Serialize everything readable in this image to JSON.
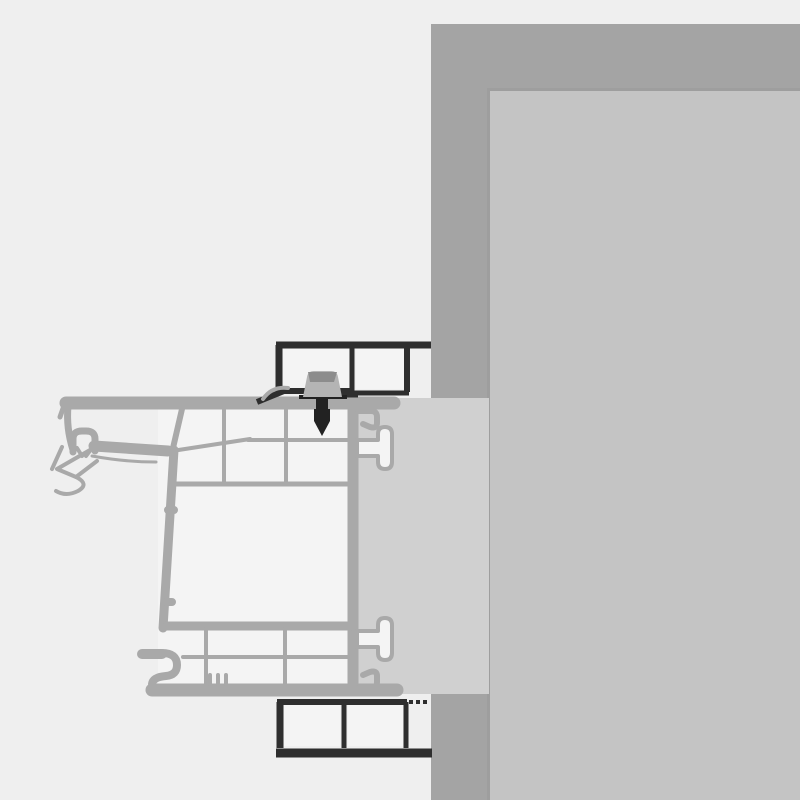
{
  "diagram": {
    "kind": "technical-cross-section",
    "parts": {
      "background": "canvas-background",
      "wall": "masonry-wall",
      "reveal": "wall-reveal-surface",
      "block": "frame-extension-block",
      "frame": "window-frame-profile",
      "gasket": "outer-gasket",
      "addon_top": "exterior-addon-profile-top",
      "addon_bottom": "exterior-addon-profile-bottom",
      "screw": "fixing-screw",
      "anchor_top": "t-anchor-top",
      "anchor_bottom": "t-anchor-bottom"
    }
  },
  "colors": {
    "background": "#efefef",
    "chamber": "#f4f4f4",
    "frame": "#a9a9a9",
    "block": "#d0d0d0",
    "wall_outer": "#a4a4a4",
    "wall_inner": "#c4c4c4",
    "wall_seam": "#9e9e9e",
    "addon_dark": "#2e2e2e",
    "screw_head": "#b4b4b4",
    "screw_hatch": "#8c8c8c",
    "screw_dark": "#222222"
  }
}
